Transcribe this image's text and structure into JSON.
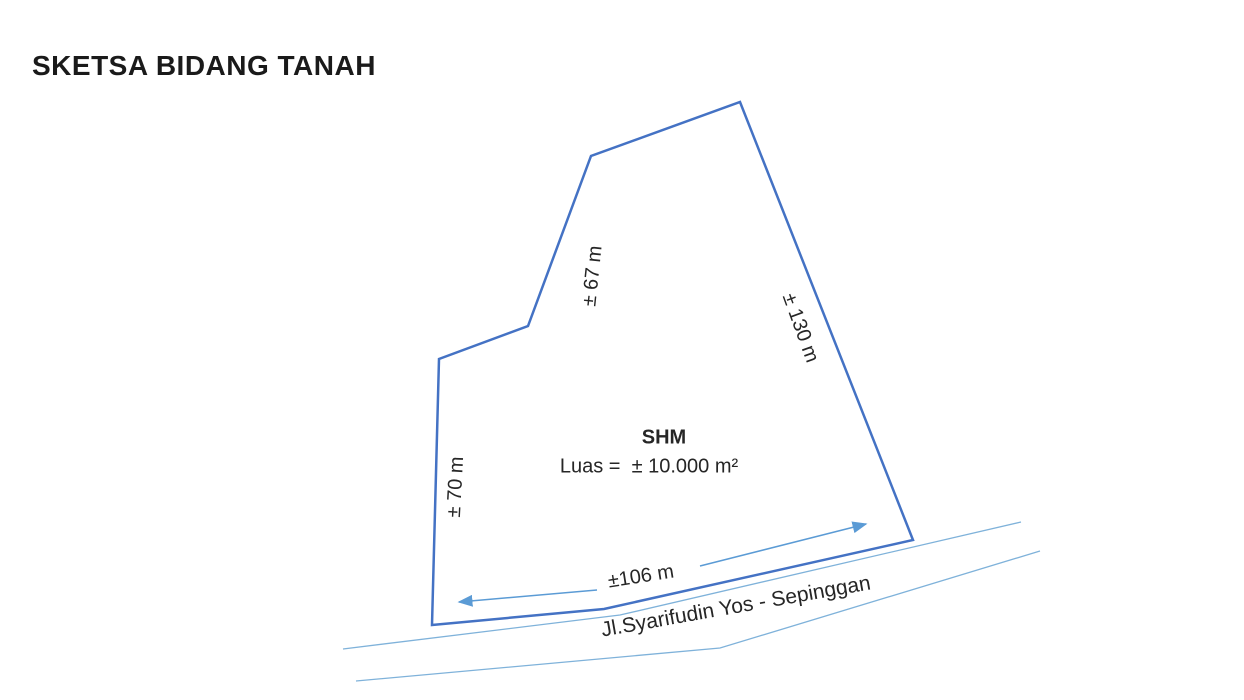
{
  "page": {
    "title": "SKETSA BIDANG TANAH"
  },
  "parcel": {
    "certificate": "SHM",
    "area": "Luas =  ± 10.000 m²",
    "outline_color": "#4472C4"
  },
  "dimensions": {
    "upper_left_edge": "± 67 m",
    "right_edge": "± 130 m",
    "left_edge": "± 70 m",
    "bottom_edge": "±106 m",
    "arrow_color": "#5B9BD5"
  },
  "road": {
    "name": "Jl.Syarifudin Yos - Sepinggan",
    "line_color": "#7FB2DA"
  }
}
